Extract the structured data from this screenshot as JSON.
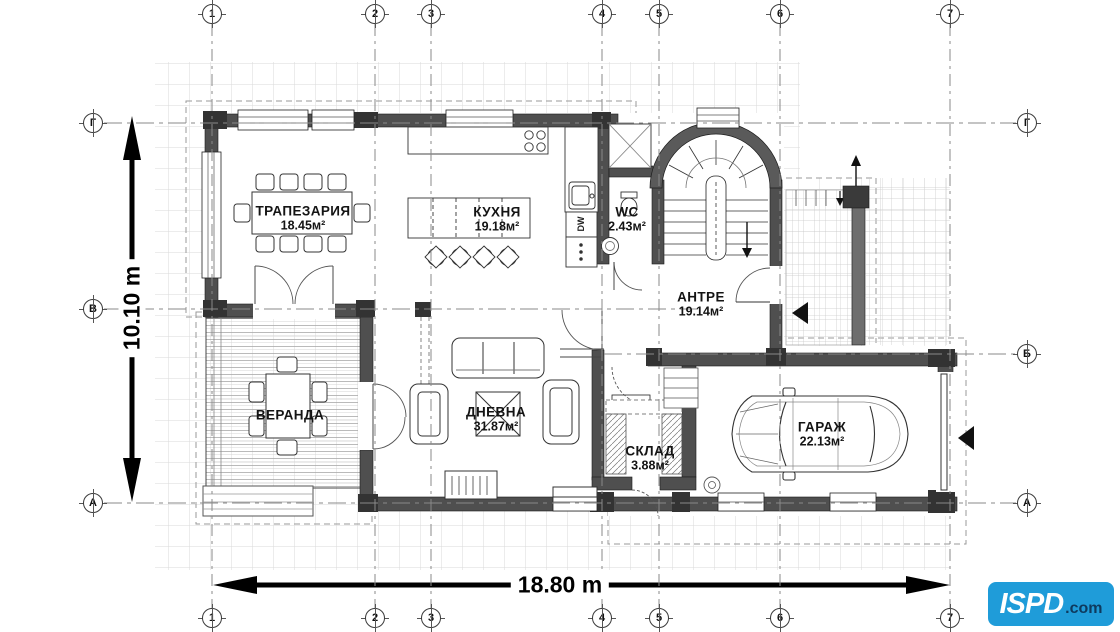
{
  "title": "House floor plan",
  "dimension_labels": {
    "horizontal": "18.80 m",
    "vertical": "10.10 m"
  },
  "grid": {
    "columns": [
      {
        "id": "1",
        "x": 212
      },
      {
        "id": "2",
        "x": 375
      },
      {
        "id": "3",
        "x": 431
      },
      {
        "id": "4",
        "x": 602
      },
      {
        "id": "5",
        "x": 659
      },
      {
        "id": "6",
        "x": 780
      },
      {
        "id": "7",
        "x": 950
      }
    ],
    "rows": [
      {
        "id": "Г",
        "y": 123,
        "x1": 104,
        "x2": 1016,
        "left": true,
        "right": true
      },
      {
        "id": "В",
        "y": 309,
        "x1": 104,
        "x2": 700,
        "left": true,
        "right": false
      },
      {
        "id": "Б",
        "y": 354,
        "x1": 604,
        "x2": 1016,
        "left": false,
        "right": true
      },
      {
        "id": "А",
        "y": 503,
        "x1": 104,
        "x2": 1016,
        "left": true,
        "right": true
      }
    ]
  },
  "rooms": [
    {
      "name": "ТРАПЕЗАРИЯ",
      "area": "18.45м²",
      "x": 303,
      "y": 219
    },
    {
      "name": "КУХНЯ",
      "area": "19.18м²",
      "x": 497,
      "y": 220
    },
    {
      "name": "WC",
      "area": "2.43м²",
      "x": 627,
      "y": 220
    },
    {
      "name": "АНТРЕ",
      "area": "19.14м²",
      "x": 701,
      "y": 305
    },
    {
      "name": "ВЕРАНДА",
      "area": "",
      "x": 290,
      "y": 416
    },
    {
      "name": "ДНЕВНА",
      "area": "31.87м²",
      "x": 496,
      "y": 420
    },
    {
      "name": "СКЛАД",
      "area": "3.88м²",
      "x": 650,
      "y": 459
    },
    {
      "name": "ГАРАЖ",
      "area": "22.13м²",
      "x": 822,
      "y": 435
    }
  ],
  "labels": {
    "dishwasher": "DW"
  },
  "logo": {
    "main": "ISPD",
    "suffix": ".com",
    "bg": "#1F9CD9",
    "suffix_color": "#0E3A5E"
  },
  "colors": {
    "wall": "#4f4f4f",
    "block": "#333333",
    "line": "#1c1c1c",
    "site_grid": "#dadada",
    "axis": "#8a8a8a"
  }
}
